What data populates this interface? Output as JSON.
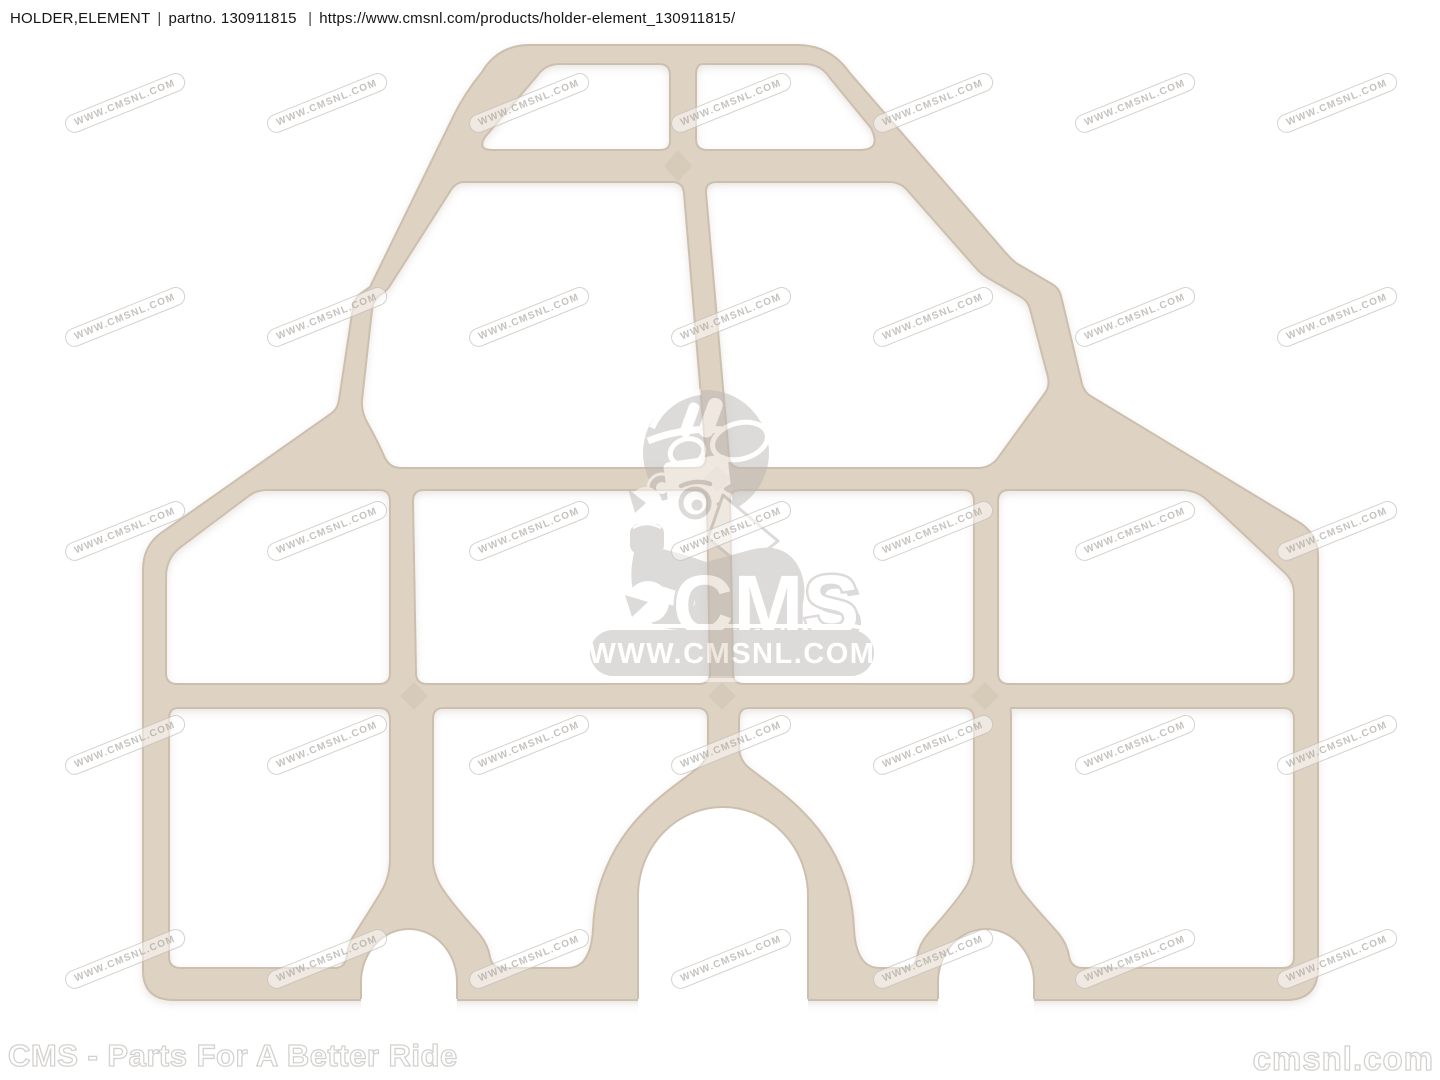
{
  "header": {
    "part_name": "HOLDER,ELEMENT",
    "divider": "|",
    "partno_label": "partno.",
    "part_number": "130911815",
    "url": "https://www.cmsnl.com/products/holder-element_130911815/"
  },
  "product": {
    "part_color": "#ded2c3",
    "part_edge_color": "#cdbfae"
  },
  "watermark": {
    "tile_text": "WWW.CMSNL.COM",
    "logo_text": "CMS",
    "logo_url_text": "WWW.CMSNL.COM",
    "gray": "#bcb8b4",
    "grid": {
      "cols": 7,
      "rows": 5,
      "x0": 125,
      "y0": 103,
      "dx": 202,
      "dy": 214,
      "angle_deg": -22
    }
  },
  "footer": {
    "left_text": "CMS - Parts For A Better Ride",
    "right_text": "cmsnl.com"
  },
  "colors": {
    "background": "#ffffff",
    "header_text": "#161616",
    "outline_text": "#d4d2cf"
  }
}
